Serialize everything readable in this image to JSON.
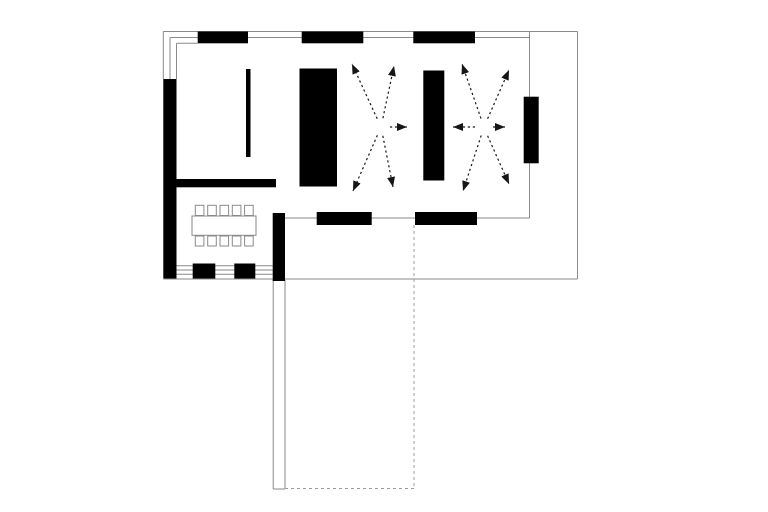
{
  "canvas": {
    "width": 768,
    "height": 512,
    "background": "#ffffff"
  },
  "colors": {
    "wall": "#000000",
    "line": "#8a8a8a",
    "dashed": "#9c9c9c",
    "arrow": "#161616",
    "furniture_stroke": "#8a8a8a",
    "furniture_fill": "#ffffff"
  },
  "plan": {
    "walls": [
      {
        "name": "north-wall-segment-1",
        "x": 197.7,
        "y": 31.5,
        "w": 50.3,
        "h": 11.8
      },
      {
        "name": "north-wall-segment-2",
        "x": 301.7,
        "y": 31.5,
        "w": 61.6,
        "h": 11.8
      },
      {
        "name": "north-wall-segment-3",
        "x": 413.3,
        "y": 31.5,
        "w": 61.7,
        "h": 11.8
      },
      {
        "name": "west-wall",
        "x": 163.3,
        "y": 79,
        "w": 13.2,
        "h": 199.5
      },
      {
        "name": "dining-north-wall",
        "x": 165,
        "y": 179,
        "w": 111,
        "h": 8.3
      },
      {
        "name": "freestanding-screen-wall",
        "x": 246,
        "y": 69,
        "w": 4.5,
        "h": 88
      },
      {
        "name": "core-wall-1",
        "x": 299.5,
        "y": 68.5,
        "w": 37.5,
        "h": 118
      },
      {
        "name": "core-wall-2",
        "x": 423.3,
        "y": 70.5,
        "w": 21,
        "h": 110
      },
      {
        "name": "east-wall-pier",
        "x": 523.7,
        "y": 96.7,
        "w": 15,
        "h": 66.6
      },
      {
        "name": "south-wall-segment-1",
        "x": 316.7,
        "y": 212,
        "w": 55,
        "h": 13
      },
      {
        "name": "south-wall-segment-2",
        "x": 415,
        "y": 212,
        "w": 62,
        "h": 13
      },
      {
        "name": "dining-east-wall",
        "x": 272.7,
        "y": 213,
        "w": 12.3,
        "h": 68
      },
      {
        "name": "window-mullion-1",
        "x": 192.7,
        "y": 263.5,
        "w": 22.6,
        "h": 15
      },
      {
        "name": "window-mullion-2",
        "x": 234.3,
        "y": 263.5,
        "w": 21,
        "h": 15
      }
    ],
    "lines": [
      {
        "name": "roof-outline-top",
        "x1": 163.3,
        "y1": 31.5,
        "x2": 577.5,
        "y2": 31.5
      },
      {
        "name": "roof-outline-right",
        "x1": 577.5,
        "y1": 31.5,
        "x2": 577.5,
        "y2": 279
      },
      {
        "name": "roof-outline-bottom",
        "x1": 163.3,
        "y1": 279,
        "x2": 577.5,
        "y2": 279
      },
      {
        "name": "north-window-glazing",
        "x1": 170,
        "y1": 37.5,
        "x2": 529.5,
        "y2": 37.5
      },
      {
        "name": "north-wall-inner-face",
        "x1": 176.5,
        "y1": 43.3,
        "x2": 197.7,
        "y2": 43.3
      },
      {
        "name": "west-wall-outer-face",
        "x1": 163.3,
        "y1": 31.5,
        "x2": 163.3,
        "y2": 79
      },
      {
        "name": "west-window-glazing",
        "x1": 170,
        "y1": 37.5,
        "x2": 170,
        "y2": 79
      },
      {
        "name": "west-wall-inner-face",
        "x1": 176.5,
        "y1": 43.3,
        "x2": 176.5,
        "y2": 79
      },
      {
        "name": "east-wall-line",
        "x1": 529.5,
        "y1": 31.5,
        "x2": 529.5,
        "y2": 218
      },
      {
        "name": "south-wall-line",
        "x1": 285,
        "y1": 218,
        "x2": 529.5,
        "y2": 218
      },
      {
        "name": "dining-window-inner-face",
        "x1": 176.5,
        "y1": 265.7,
        "x2": 272.7,
        "y2": 265.7
      },
      {
        "name": "dining-window-glazing-1",
        "x1": 176.5,
        "y1": 270,
        "x2": 272.7,
        "y2": 270
      },
      {
        "name": "dining-window-glazing-2",
        "x1": 176.5,
        "y1": 274.3,
        "x2": 272.7,
        "y2": 274.3
      },
      {
        "name": "patio-wall-outer-face",
        "x1": 273.2,
        "y1": 280,
        "x2": 273.2,
        "y2": 489
      },
      {
        "name": "patio-wall-inner-face",
        "x1": 285,
        "y1": 280,
        "x2": 285,
        "y2": 489
      },
      {
        "name": "patio-wall-end-cap",
        "x1": 273.2,
        "y1": 489,
        "x2": 285,
        "y2": 489
      }
    ],
    "dashed_lines": [
      {
        "name": "terrace-outline-right",
        "x1": 414,
        "y1": 225,
        "x2": 414,
        "y2": 488.5
      },
      {
        "name": "terrace-outline-bottom",
        "x1": 285,
        "y1": 488.5,
        "x2": 414,
        "y2": 488.5
      }
    ],
    "furniture": {
      "table": {
        "name": "dining-table",
        "x": 192,
        "y": 216,
        "w": 64,
        "h": 19.3
      },
      "chairs": [
        {
          "name": "dining-chair",
          "x": 195.3,
          "y": 205.3,
          "w": 8.6,
          "h": 10.2
        },
        {
          "name": "dining-chair",
          "x": 207.7,
          "y": 205.3,
          "w": 8.6,
          "h": 10.2
        },
        {
          "name": "dining-chair",
          "x": 220.0,
          "y": 205.3,
          "w": 8.6,
          "h": 10.2
        },
        {
          "name": "dining-chair",
          "x": 232.3,
          "y": 205.3,
          "w": 8.6,
          "h": 10.2
        },
        {
          "name": "dining-chair",
          "x": 244.6,
          "y": 205.3,
          "w": 8.6,
          "h": 10.2
        },
        {
          "name": "dining-chair",
          "x": 195.3,
          "y": 236,
          "w": 8.6,
          "h": 10
        },
        {
          "name": "dining-chair",
          "x": 207.7,
          "y": 236,
          "w": 8.6,
          "h": 10
        },
        {
          "name": "dining-chair",
          "x": 220.0,
          "y": 236,
          "w": 8.6,
          "h": 10
        },
        {
          "name": "dining-chair",
          "x": 232.3,
          "y": 236,
          "w": 8.6,
          "h": 10
        },
        {
          "name": "dining-chair",
          "x": 244.6,
          "y": 236,
          "w": 8.6,
          "h": 10
        }
      ]
    },
    "arrow_clusters": [
      {
        "name": "radiating-arrows-left",
        "center": [
          381,
          127
        ],
        "arrows": [
          {
            "from": [
              377.2,
              118.8
            ],
            "to": [
              352,
              64
            ]
          },
          {
            "from": [
              382.9,
              118.2
            ],
            "to": [
              394,
              66
            ]
          },
          {
            "from": [
              390,
              127
            ],
            "to": [
              407,
              127
            ]
          },
          {
            "from": [
              377.4,
              135.2
            ],
            "to": [
              353,
              191
            ]
          },
          {
            "from": [
              382.8,
              135.8
            ],
            "to": [
              393,
              187
            ]
          }
        ]
      },
      {
        "name": "radiating-arrows-right",
        "center": [
          484,
          127
        ],
        "arrows": [
          {
            "from": [
              481,
              118.5
            ],
            "to": [
              462,
              64
            ]
          },
          {
            "from": [
              487.6,
              118.7
            ],
            "to": [
              509,
              70
            ]
          },
          {
            "from": [
              475,
              127
            ],
            "to": [
              453,
              127
            ]
          },
          {
            "from": [
              493,
              127
            ],
            "to": [
              505,
              127
            ]
          },
          {
            "from": [
              481.2,
              135.5
            ],
            "to": [
              463,
              191
            ]
          },
          {
            "from": [
              487.6,
              135.8
            ],
            "to": [
              509,
              184
            ]
          }
        ]
      }
    ]
  }
}
